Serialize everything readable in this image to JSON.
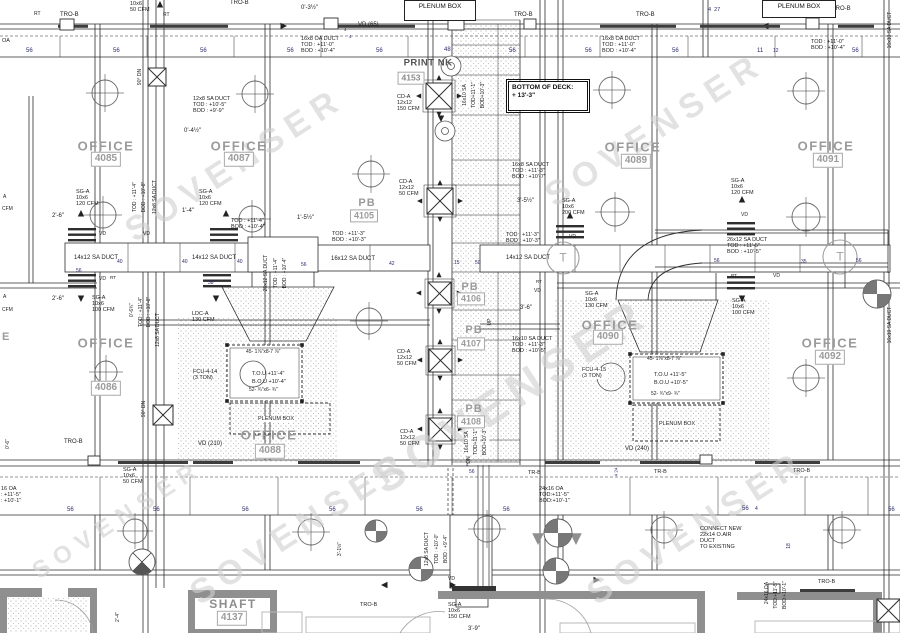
{
  "colors": {
    "line": "#2e2e2e",
    "wall_gray": "#8f8f8f",
    "room_label": "#9b9b9b",
    "number_blue": "#2b2b6a",
    "watermark": "#d0d0d0"
  },
  "watermark": {
    "text": "SOVENSER",
    "instances": [
      {
        "x": 235,
        "y": 165
      },
      {
        "x": 655,
        "y": 130
      },
      {
        "x": 510,
        "y": 395,
        "s": 46
      },
      {
        "x": 300,
        "y": 528
      },
      {
        "x": 697,
        "y": 528
      },
      {
        "x": 118,
        "y": 520,
        "s": 24
      }
    ]
  },
  "rooms": [
    {
      "name": "OFFICE",
      "number": "4085",
      "lx": 106,
      "ly": 146,
      "bx": 106,
      "by": 159,
      "cls": ""
    },
    {
      "name": "OFFICE",
      "number": "4087",
      "lx": 239,
      "ly": 146,
      "bx": 239,
      "by": 159,
      "cls": ""
    },
    {
      "name": "OFFICE",
      "number": "4089",
      "lx": 633,
      "ly": 147,
      "bx": 636,
      "by": 161,
      "cls": ""
    },
    {
      "name": "OFFICE",
      "number": "4091",
      "lx": 826,
      "ly": 146,
      "bx": 828,
      "by": 160,
      "cls": ""
    },
    {
      "name": "OFFICE",
      "number": "4086",
      "lx": 106,
      "ly": 343,
      "bx": 106,
      "by": 388,
      "cls": ""
    },
    {
      "name": "OFFICE",
      "number": "4088",
      "lx": 269,
      "ly": 435,
      "bx": 270,
      "by": 451,
      "cls": ""
    },
    {
      "name": "OFFICE",
      "number": "4090",
      "lx": 610,
      "ly": 325,
      "bx": 608,
      "by": 337,
      "cls": ""
    },
    {
      "name": "OFFICE",
      "number": "4092",
      "lx": 830,
      "ly": 343,
      "bx": 830,
      "by": 357,
      "cls": ""
    },
    {
      "name": "PB",
      "number": "4105",
      "lx": 367,
      "ly": 203,
      "bx": 364,
      "by": 216,
      "cls": "pb"
    },
    {
      "name": "PB",
      "number": "4106",
      "lx": 470,
      "ly": 287,
      "bx": 471,
      "by": 299,
      "cls": "pb"
    },
    {
      "name": "PB",
      "number": "4107",
      "lx": 474,
      "ly": 330,
      "bx": 471,
      "by": 344,
      "cls": "pb"
    },
    {
      "name": "PB",
      "number": "4108",
      "lx": 474,
      "ly": 409,
      "bx": 471,
      "by": 422,
      "cls": "pb"
    },
    {
      "name": "PRINT NK",
      "number": "4153",
      "lx": 428,
      "ly": 63,
      "bx": 411,
      "by": 78,
      "cls": "print"
    },
    {
      "name": "SHAFT",
      "number": "4137",
      "lx": 233,
      "ly": 604,
      "bx": 232,
      "by": 618,
      "cls": "shaft"
    }
  ],
  "boxed_notes": [
    {
      "name": "bottom-of-deck-note",
      "text": "BOTTOM OF DECK:\n+ 13'-3\"",
      "x": 508,
      "y": 81,
      "w": 72,
      "h": 24,
      "cls": ""
    },
    {
      "name": "plenum-box-note-top",
      "text": "PLENUM BOX",
      "x": 404,
      "y": 0,
      "w": 64,
      "h": 15,
      "cls": "thin"
    },
    {
      "name": "plenum-box-note-topright",
      "text": "PLENUM BOX",
      "x": 762,
      "y": 0,
      "w": 66,
      "h": 12,
      "cls": "thin"
    }
  ],
  "labels": [
    {
      "t": "RT",
      "x": 34,
      "y": 12,
      "s": 5
    },
    {
      "t": "TRO-B",
      "x": 60,
      "y": 12
    },
    {
      "t": "10x6\n50 CFM",
      "x": 130,
      "y": 1,
      "s": 5.5
    },
    {
      "t": "RT",
      "x": 163,
      "y": 13,
      "s": 5
    },
    {
      "t": "TRO-B",
      "x": 230,
      "y": 0
    },
    {
      "t": "0'-3½\"",
      "x": 301,
      "y": 5
    },
    {
      "t": "4",
      "x": 344,
      "y": 27,
      "s": 4.5,
      "c": "#2b2b6a"
    },
    {
      "t": "4",
      "x": 349,
      "y": 34,
      "s": 4.5,
      "c": "#2b2b6a"
    },
    {
      "t": "VD (65)",
      "x": 358,
      "y": 22
    },
    {
      "t": "TRO-B",
      "x": 514,
      "y": 12
    },
    {
      "t": "TRO-B",
      "x": 636,
      "y": 12
    },
    {
      "t": "4  27",
      "x": 708,
      "y": 7,
      "s": 5.5,
      "c": "#2b2b6a"
    },
    {
      "t": "TRO-B",
      "x": 832,
      "y": 6
    },
    {
      "t": "OA",
      "x": 2,
      "y": 38,
      "s": 5.5
    },
    {
      "t": "16x8 OA DUCT\nTOD : +11'-0\"\nBOD : +10'-4\"",
      "x": 301,
      "y": 36,
      "s": 5.5
    },
    {
      "t": "16x8 OA DUCT\nTOD : +11'-0\"\nBOD : +10'-4\"",
      "x": 602,
      "y": 36,
      "s": 5.5
    },
    {
      "t": "TOD : +11'-0\"\nBOD : +10'-4\"",
      "x": 811,
      "y": 39,
      "s": 5.5
    },
    {
      "t": "56",
      "x": 26,
      "y": 48,
      "c": "#2b2b6a"
    },
    {
      "t": "56",
      "x": 113,
      "y": 48,
      "c": "#2b2b6a"
    },
    {
      "t": "56",
      "x": 200,
      "y": 48,
      "c": "#2b2b6a"
    },
    {
      "t": "56",
      "x": 287,
      "y": 48,
      "c": "#2b2b6a"
    },
    {
      "t": "56",
      "x": 376,
      "y": 48,
      "c": "#2b2b6a"
    },
    {
      "t": "48",
      "x": 444,
      "y": 47,
      "c": "#2b2b6a"
    },
    {
      "t": "56",
      "x": 509,
      "y": 48,
      "c": "#2b2b6a"
    },
    {
      "t": "56",
      "x": 585,
      "y": 48,
      "c": "#2b2b6a"
    },
    {
      "t": "56",
      "x": 672,
      "y": 48,
      "c": "#2b2b6a"
    },
    {
      "t": "11",
      "x": 757,
      "y": 48,
      "c": "#2b2b6a"
    },
    {
      "t": "12",
      "x": 773,
      "y": 49,
      "s": 5,
      "c": "#2b2b6a"
    },
    {
      "t": "56",
      "x": 852,
      "y": 48,
      "c": "#2b2b6a"
    },
    {
      "t": "12x8 SA DUCT\nTOD : +10'-5\"\nBOD : +9'-9\"",
      "x": 193,
      "y": 96,
      "s": 5.5
    },
    {
      "t": "0'-4½\"",
      "x": 184,
      "y": 128
    },
    {
      "t": "CD-A\n12x12\n150 CFM",
      "x": 397,
      "y": 94,
      "s": 5.5
    },
    {
      "t": "16x8 SA DUCT\nTOD : +11'-3\"\nBOD : +10'-7\"",
      "x": 512,
      "y": 162,
      "s": 5.5
    },
    {
      "t": "90° DN",
      "x": 141,
      "y": 77,
      "r": 1,
      "s": 5
    },
    {
      "t": "SG-A\n10x6\n120 CFM",
      "x": 76,
      "y": 189,
      "s": 5.5
    },
    {
      "t": "SG-A\n10x6\n120 CFM",
      "x": 199,
      "y": 189,
      "s": 5.5
    },
    {
      "t": "1'-4\"",
      "x": 182,
      "y": 208
    },
    {
      "t": "CD-A\n12x12\n50 CFM",
      "x": 399,
      "y": 179,
      "s": 5.5
    },
    {
      "t": "SG-A\n10x6\n200 CFM",
      "x": 562,
      "y": 198,
      "s": 5.5
    },
    {
      "t": "3'-5½\"",
      "x": 517,
      "y": 198
    },
    {
      "t": "SG-A\n10x6\n120 CFM",
      "x": 731,
      "y": 178,
      "s": 5.5
    },
    {
      "t": "2'-6\"",
      "x": 52,
      "y": 213
    },
    {
      "t": "VD",
      "x": 99,
      "y": 232,
      "s": 5
    },
    {
      "t": "VD",
      "x": 143,
      "y": 232,
      "s": 5
    },
    {
      "t": "VD",
      "x": 99,
      "y": 277,
      "s": 5
    },
    {
      "t": "VD",
      "x": 741,
      "y": 213,
      "s": 5
    },
    {
      "t": "VD",
      "x": 569,
      "y": 235,
      "s": 5
    },
    {
      "t": "VD",
      "x": 534,
      "y": 289,
      "s": 5
    },
    {
      "t": "VD",
      "x": 773,
      "y": 274,
      "s": 5
    },
    {
      "t": "RT",
      "x": 110,
      "y": 275,
      "s": 4.5
    },
    {
      "t": "RT",
      "x": 536,
      "y": 279,
      "s": 4.5
    },
    {
      "t": "RT",
      "x": 731,
      "y": 273,
      "s": 4.5
    },
    {
      "t": "TOD : +11'-4\"\nBOD : +10'-4\"",
      "x": 231,
      "y": 218,
      "s": 5.5
    },
    {
      "t": "TOD : +11'-3\"\nBOD : +10'-3\"",
      "x": 332,
      "y": 231,
      "s": 5.5
    },
    {
      "t": "TOD : +11'-3\"\nBOD : +10'-3\"",
      "x": 506,
      "y": 232,
      "s": 5.5
    },
    {
      "t": "26x12 SA DUCT\nTOD : +11'-5\"\nBOD : +10'-5\"",
      "x": 727,
      "y": 237,
      "s": 5.5
    },
    {
      "t": "14x12 SA DUCT",
      "x": 74,
      "y": 255
    },
    {
      "t": "14x12 SA DUCT",
      "x": 192,
      "y": 255
    },
    {
      "t": "16x12 SA DUCT",
      "x": 331,
      "y": 256
    },
    {
      "t": "14x12 SA DUCT",
      "x": 506,
      "y": 255
    },
    {
      "t": "1'-5½\"",
      "x": 297,
      "y": 215
    },
    {
      "t": "40",
      "x": 117,
      "y": 260,
      "s": 5,
      "c": "#2b2b6a"
    },
    {
      "t": "40",
      "x": 182,
      "y": 260,
      "s": 5,
      "c": "#2b2b6a"
    },
    {
      "t": "40",
      "x": 237,
      "y": 260,
      "s": 5,
      "c": "#2b2b6a"
    },
    {
      "t": "56",
      "x": 76,
      "y": 269,
      "s": 5,
      "c": "#2b2b6a"
    },
    {
      "t": "56",
      "x": 301,
      "y": 263,
      "s": 5,
      "c": "#2b2b6a"
    },
    {
      "t": "42",
      "x": 389,
      "y": 262,
      "s": 5,
      "c": "#2b2b6a"
    },
    {
      "t": "15",
      "x": 454,
      "y": 261,
      "s": 5,
      "c": "#2b2b6a"
    },
    {
      "t": "50",
      "x": 475,
      "y": 261,
      "s": 5,
      "c": "#2b2b6a"
    },
    {
      "t": "38",
      "x": 208,
      "y": 281,
      "s": 5,
      "c": "#2b2b6a"
    },
    {
      "t": "56",
      "x": 714,
      "y": 259,
      "s": 5,
      "c": "#2b2b6a"
    },
    {
      "t": "35",
      "x": 801,
      "y": 260,
      "s": 5,
      "c": "#2b2b6a"
    },
    {
      "t": "56",
      "x": 856,
      "y": 259,
      "s": 5,
      "c": "#2b2b6a"
    },
    {
      "t": "TOD : +11'-4\"",
      "x": 136,
      "y": 197,
      "r": 1,
      "s": 5
    },
    {
      "t": "BOD : +10'-8\"",
      "x": 145,
      "y": 197,
      "r": 1,
      "s": 5
    },
    {
      "t": "12x8 SA DUCT",
      "x": 156,
      "y": 197,
      "r": 1,
      "s": 5
    },
    {
      "t": "16x10 SA",
      "x": 466,
      "y": 95,
      "r": 1,
      "s": 5,
      "bg": 1
    },
    {
      "t": "TOD+11'-1\"",
      "x": 475,
      "y": 95,
      "r": 1,
      "s": 5,
      "bg": 1
    },
    {
      "t": "BOD+10'-3\"",
      "x": 484,
      "y": 95,
      "r": 1,
      "s": 5,
      "bg": 1
    },
    {
      "t": "26x12 SA DUCT",
      "x": 267,
      "y": 273,
      "r": 1,
      "s": 5
    },
    {
      "t": "TOD : +11'-4\"",
      "x": 277,
      "y": 273,
      "r": 1,
      "s": 5
    },
    {
      "t": "BOD : +10'-4\"",
      "x": 286,
      "y": 273,
      "r": 1,
      "s": 5
    },
    {
      "t": "0'-6¾\"",
      "x": 133,
      "y": 310,
      "r": 1,
      "s": 5
    },
    {
      "t": "TOD : +11'-4\"",
      "x": 142,
      "y": 312,
      "r": 1,
      "s": 5
    },
    {
      "t": "BOD : +10'-8\"",
      "x": 150,
      "y": 312,
      "r": 1,
      "s": 5
    },
    {
      "t": "12x8 SA DUCT",
      "x": 159,
      "y": 330,
      "r": 1,
      "s": 5
    },
    {
      "t": "UP",
      "x": 491,
      "y": 322,
      "r": 1,
      "s": 5
    },
    {
      "t": "90° DN",
      "x": 145,
      "y": 409,
      "r": 1,
      "s": 5
    },
    {
      "t": "SG-A\n10x6\n100 CFM",
      "x": 92,
      "y": 295,
      "s": 5.5
    },
    {
      "t": "2'-6\"",
      "x": 52,
      "y": 296
    },
    {
      "t": "LDC-A\n130 CFM",
      "x": 192,
      "y": 311,
      "s": 5.5
    },
    {
      "t": "SG-A\n10x6\n130 CFM",
      "x": 585,
      "y": 291,
      "s": 5.5
    },
    {
      "t": "3'-6\"",
      "x": 520,
      "y": 305
    },
    {
      "t": "SG-A\n10x6\n100 CFM",
      "x": 732,
      "y": 298,
      "s": 5.5
    },
    {
      "t": "A",
      "x": 3,
      "y": 195,
      "s": 5
    },
    {
      "t": "CFM",
      "x": 2,
      "y": 207,
      "s": 5
    },
    {
      "t": "A",
      "x": 3,
      "y": 295,
      "s": 5
    },
    {
      "t": "CFM",
      "x": 2,
      "y": 308,
      "s": 5
    },
    {
      "t": "E",
      "x": 2,
      "y": 331,
      "s": 11,
      "b": 1,
      "c": "#9b9b9b"
    },
    {
      "t": "T",
      "x": 563,
      "y": 258,
      "a": 1,
      "s": 12,
      "c": "#9e9e9e"
    },
    {
      "t": "T",
      "x": 840,
      "y": 257,
      "a": 1,
      "s": 12,
      "c": "#9e9e9e"
    },
    {
      "t": "16x10 SA DUCT\nTOD : +11'-3\"\nBOD : +10'-5\"",
      "x": 512,
      "y": 336,
      "s": 5.5
    },
    {
      "t": "FCU-4-14\n(3 TON)",
      "x": 193,
      "y": 369,
      "s": 5.5
    },
    {
      "t": "45- 1⅞\"x8-7 ⅞\"",
      "x": 246,
      "y": 350,
      "s": 5
    },
    {
      "t": "T.O.U +11'-4\"",
      "x": 252,
      "y": 371,
      "s": 5.5
    },
    {
      "t": "B.O.U +10'-4\"",
      "x": 252,
      "y": 379,
      "s": 5.5
    },
    {
      "t": "52- ¾\"x6- ¾\"",
      "x": 249,
      "y": 388,
      "s": 5
    },
    {
      "t": "PLENUM BOX",
      "x": 257,
      "y": 416,
      "s": 5.5,
      "bg": 1
    },
    {
      "t": "CD-A\n12x12\n50 CFM",
      "x": 397,
      "y": 349,
      "s": 5.5
    },
    {
      "t": "CD-A\n12x12\n50 CFM",
      "x": 400,
      "y": 429,
      "s": 5.5
    },
    {
      "t": "FCU-4-15\n(3 TON)",
      "x": 581,
      "y": 367,
      "s": 5.5,
      "bg": 1
    },
    {
      "t": "45- 1⅞\"x8-7 ⅞\"",
      "x": 647,
      "y": 357,
      "s": 5
    },
    {
      "t": "T.O.U +11'-5\"",
      "x": 654,
      "y": 372,
      "s": 5.5
    },
    {
      "t": "B.O.U +10'-5\"",
      "x": 654,
      "y": 380,
      "s": 5.5
    },
    {
      "t": "52- ¾\"x9- ¾\"",
      "x": 651,
      "y": 392,
      "s": 5
    },
    {
      "t": "PLENUM BOX",
      "x": 658,
      "y": 421,
      "s": 5.5,
      "bg": 1
    },
    {
      "t": "VD (210)",
      "x": 198,
      "y": 441
    },
    {
      "t": "VD (240)",
      "x": 625,
      "y": 446
    },
    {
      "t": "TRO-B",
      "x": 64,
      "y": 439
    },
    {
      "t": "0'-6\"",
      "x": 9,
      "y": 444,
      "r": 1,
      "s": 5
    },
    {
      "t": "16x10 SA",
      "x": 468,
      "y": 442,
      "r": 1,
      "s": 5,
      "bg": 1
    },
    {
      "t": "TOD+11'-1\"",
      "x": 477,
      "y": 442,
      "r": 1,
      "s": 5,
      "bg": 1
    },
    {
      "t": "BOD+10'-3\"",
      "x": 486,
      "y": 442,
      "r": 1,
      "s": 5,
      "bg": 1
    },
    {
      "t": "DN",
      "x": 470,
      "y": 460,
      "r": 1,
      "s": 5
    },
    {
      "t": "TR-B",
      "x": 528,
      "y": 470,
      "s": 5.5
    },
    {
      "t": "TR-B",
      "x": 654,
      "y": 469,
      "s": 5.5
    },
    {
      "t": "TRO-B",
      "x": 793,
      "y": 468,
      "s": 5.5
    },
    {
      "t": "4",
      "x": 466,
      "y": 462,
      "s": 4.5,
      "c": "#2b2b6a"
    },
    {
      "t": "56",
      "x": 469,
      "y": 470,
      "s": 5,
      "c": "#2b2b6a"
    },
    {
      "t": "4 24",
      "x": 616,
      "y": 472,
      "r": 1,
      "s": 4.5,
      "c": "#2b2b6a"
    },
    {
      "t": "16 OA\n: +11'-5\"\n: +10'-1\"",
      "x": 1,
      "y": 486,
      "s": 5.5
    },
    {
      "t": "SG-A\n10x6\n50 CFM",
      "x": 123,
      "y": 467,
      "s": 5.5
    },
    {
      "t": "24x16 OA\nTOD:+11'-5\"\nBOD:+10'-1\"",
      "x": 539,
      "y": 486,
      "s": 5.5
    },
    {
      "t": "56",
      "x": 67,
      "y": 507,
      "c": "#2b2b6a"
    },
    {
      "t": "56",
      "x": 153,
      "y": 507,
      "c": "#2b2b6a"
    },
    {
      "t": "56",
      "x": 242,
      "y": 507,
      "c": "#2b2b6a"
    },
    {
      "t": "56",
      "x": 329,
      "y": 507,
      "c": "#2b2b6a"
    },
    {
      "t": "56",
      "x": 416,
      "y": 507,
      "c": "#2b2b6a"
    },
    {
      "t": "56",
      "x": 503,
      "y": 507,
      "c": "#2b2b6a"
    },
    {
      "t": "56",
      "x": 742,
      "y": 506,
      "c": "#2b2b6a"
    },
    {
      "t": "4",
      "x": 755,
      "y": 507,
      "s": 5,
      "c": "#2b2b6a"
    },
    {
      "t": "56",
      "x": 888,
      "y": 507,
      "c": "#2b2b6a"
    },
    {
      "t": "CONNECT NEW\n22x14 O.AIR\nDUCT\nTO EXISTING",
      "x": 700,
      "y": 526,
      "s": 5.5
    },
    {
      "t": "3'-1½\"",
      "x": 341,
      "y": 549,
      "r": 1,
      "s": 5
    },
    {
      "t": "12x8 SA DUCT",
      "x": 428,
      "y": 549,
      "r": 1,
      "s": 5
    },
    {
      "t": "TOD : +10'-0\"",
      "x": 438,
      "y": 549,
      "r": 1,
      "s": 5
    },
    {
      "t": "BOD : +9'-4\"",
      "x": 447,
      "y": 549,
      "r": 1,
      "s": 5
    },
    {
      "t": "18",
      "x": 790,
      "y": 546,
      "r": 1,
      "s": 5,
      "c": "#2b2b6a"
    },
    {
      "t": "VD",
      "x": 448,
      "y": 577,
      "s": 5
    },
    {
      "t": "TRO-B",
      "x": 360,
      "y": 602,
      "s": 5.5
    },
    {
      "t": "SG-A\n10x6\n150 CFM",
      "x": 448,
      "y": 602,
      "s": 5.5
    },
    {
      "t": "3'-9\"",
      "x": 468,
      "y": 626
    },
    {
      "t": "TRO-B",
      "x": 818,
      "y": 579,
      "s": 5.5
    },
    {
      "t": "24x16 OA",
      "x": 768,
      "y": 593,
      "r": 1,
      "s": 5
    },
    {
      "t": "TOD:+11'-5\"",
      "x": 777,
      "y": 595,
      "r": 1,
      "s": 5
    },
    {
      "t": "BOD:+10'-1\"",
      "x": 786,
      "y": 595,
      "r": 1,
      "s": 5
    },
    {
      "t": "2'-4\"",
      "x": 119,
      "y": 617,
      "r": 1,
      "s": 5
    },
    {
      "t": "16x10 SA DUCT",
      "x": 891,
      "y": 30,
      "r": 1,
      "s": 5
    },
    {
      "t": "16x10 SA DUCT",
      "x": 891,
      "y": 325,
      "r": 1,
      "s": 5
    }
  ]
}
